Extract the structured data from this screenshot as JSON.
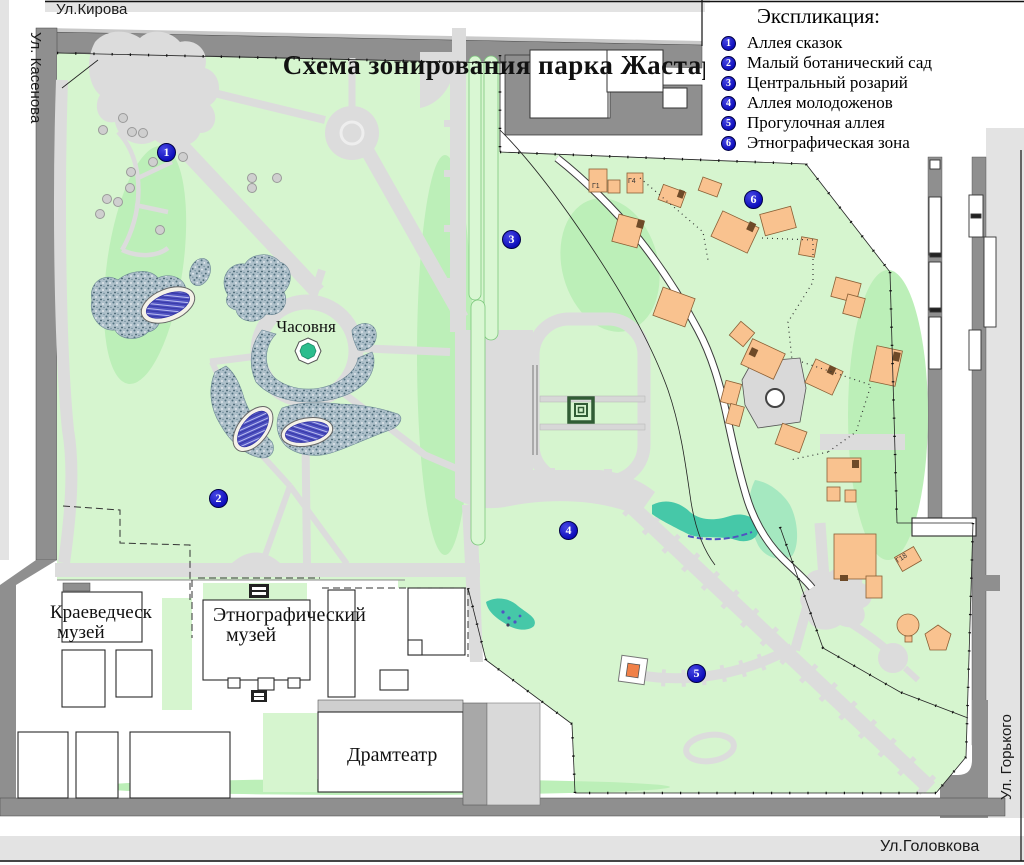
{
  "map": {
    "title": "Схема зонирования парка Жастар"
  },
  "legend": {
    "heading": "Экспликация:",
    "items": [
      {
        "num": "1",
        "label": "Аллея сказок"
      },
      {
        "num": "2",
        "label": "Малый ботанический сад"
      },
      {
        "num": "3",
        "label": "Центральный розарий"
      },
      {
        "num": "4",
        "label": "Аллея молодоженов"
      },
      {
        "num": "5",
        "label": "Прогулочная аллея"
      },
      {
        "num": "6",
        "label": "Этнографическая зона"
      }
    ]
  },
  "streets": {
    "top": "Ул.Кирова",
    "left": "Ул. Касенова",
    "right": "Ул. Горького",
    "bottom": "Ул.Головкова"
  },
  "places": {
    "chapel": "Часовня",
    "local_museum_line1": "Краеведческ",
    "local_museum_line2": "музей",
    "ethno_museum_line1": "Этнографический",
    "ethno_museum_line2": "музей",
    "drama_theater": "Драмтеатр"
  },
  "building_codes": {
    "g1": "Г1",
    "g4": "Г4",
    "g18": "Г18"
  },
  "markers": [
    {
      "num": "1"
    },
    {
      "num": "2"
    },
    {
      "num": "3"
    },
    {
      "num": "4"
    },
    {
      "num": "5"
    },
    {
      "num": "6"
    }
  ],
  "colors": {
    "park_green": "#d6f5cf",
    "marker_blue": "#1212c8",
    "building_orange": "#f9c28f",
    "water_teal": "#46c8a8",
    "pond_purple": "#5053c2"
  }
}
